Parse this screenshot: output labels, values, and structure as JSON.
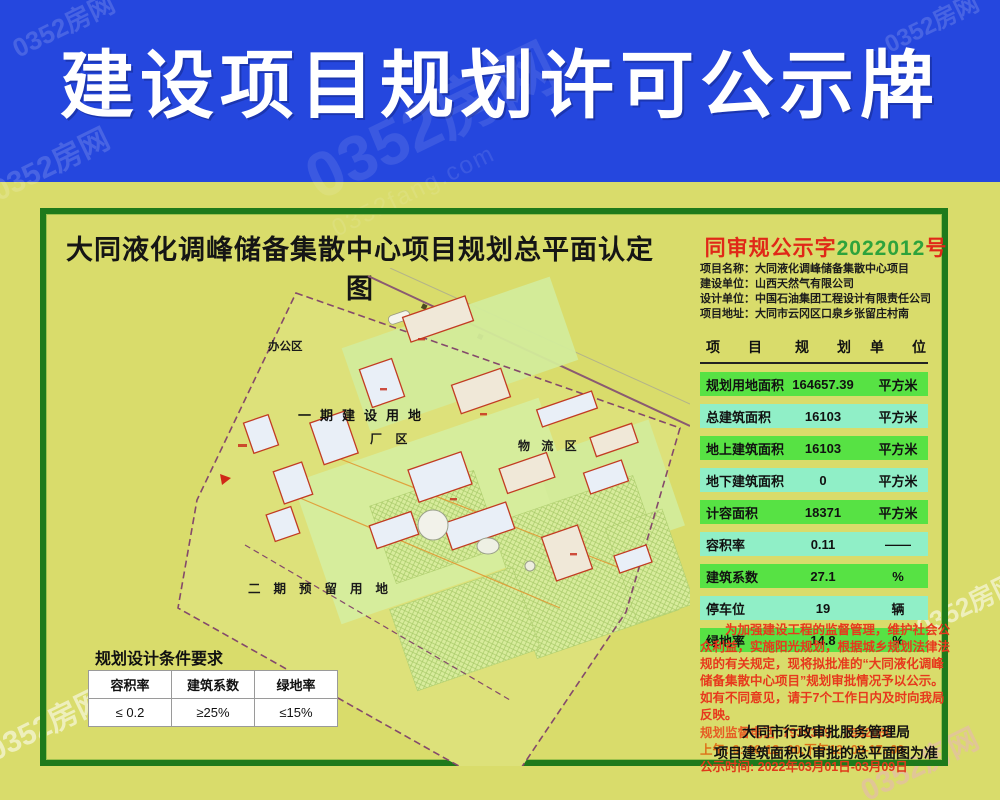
{
  "banner": {
    "title": "建设项目规划许可公示牌"
  },
  "watermark": {
    "text": "0352房网",
    "sub": "0352fang.com"
  },
  "plan": {
    "title": "大同液化调峰储备集散中心项目规划总平面认定图",
    "areas": {
      "office": "办公区",
      "phase1": "一期建设用地",
      "factory": "厂 区",
      "logistics": "物 流 区",
      "phase2": "二期预留用地"
    }
  },
  "notice": {
    "number_prefix": "同审规公示字",
    "number_value": "2022012",
    "number_suffix": "号"
  },
  "info": [
    "项目名称：大同液化调峰储备集散中心项目",
    "建设单位：山西天然气有限公司",
    "设计单位：中国石油集团工程设计有限责任公司",
    "项目地址：大同市云冈区口泉乡张留庄村南"
  ],
  "table": {
    "headers": [
      "项　　目",
      "规　　划",
      "单　　位"
    ],
    "rows": [
      {
        "item": "规划用地面积",
        "value": "164657.39",
        "unit": "平方米"
      },
      {
        "item": "总建筑面积",
        "value": "16103",
        "unit": "平方米"
      },
      {
        "item": "地上建筑面积",
        "value": "16103",
        "unit": "平方米"
      },
      {
        "item": "地下建筑面积",
        "value": "0",
        "unit": "平方米"
      },
      {
        "item": "计容面积",
        "value": "18371",
        "unit": "平方米"
      },
      {
        "item": "容积率",
        "value": "0.11",
        "unit": "——"
      },
      {
        "item": "建筑系数",
        "value": "27.1",
        "unit": "%"
      },
      {
        "item": "停车位",
        "value": "19",
        "unit": "辆"
      },
      {
        "item": "绿地率",
        "value": "14.8",
        "unit": "%"
      }
    ]
  },
  "announcement": {
    "paragraph": "为加强建设工程的监督管理，维护社会公众利益，实施阳光规划，根据城乡规划法律法规的有关规定，现将拟批准的“大同液化调峰储备集散中心项目”规划审批情况予以公示。如有不同意见，请于7个工作日内及时向我局反映。",
    "phone": "规划监督电话: 7939399　7982060",
    "hours": "上午: 9: 00-12: 00,下午13: 00-17: 00",
    "period": "公示时间: 2022年03月01日-03月09日"
  },
  "footer": {
    "agency": "大同市行政审批服务管理局",
    "note": "项目建筑面积以审批的总平面图为准"
  },
  "conditions": {
    "title": "规划设计条件要求",
    "headers": [
      "容积率",
      "建筑系数",
      "绿地率"
    ],
    "values": [
      "≤ 0.2",
      "≥25%",
      "≤15%"
    ]
  },
  "colors": {
    "banner_blue": "#2547de",
    "frame_green": "#1e7a1b",
    "row_green": "#57e244",
    "row_aqua": "#90efc7",
    "notice_red": "#e7391d",
    "number_green": "#2ea33c",
    "body_yellow": "#d9dc6b"
  }
}
